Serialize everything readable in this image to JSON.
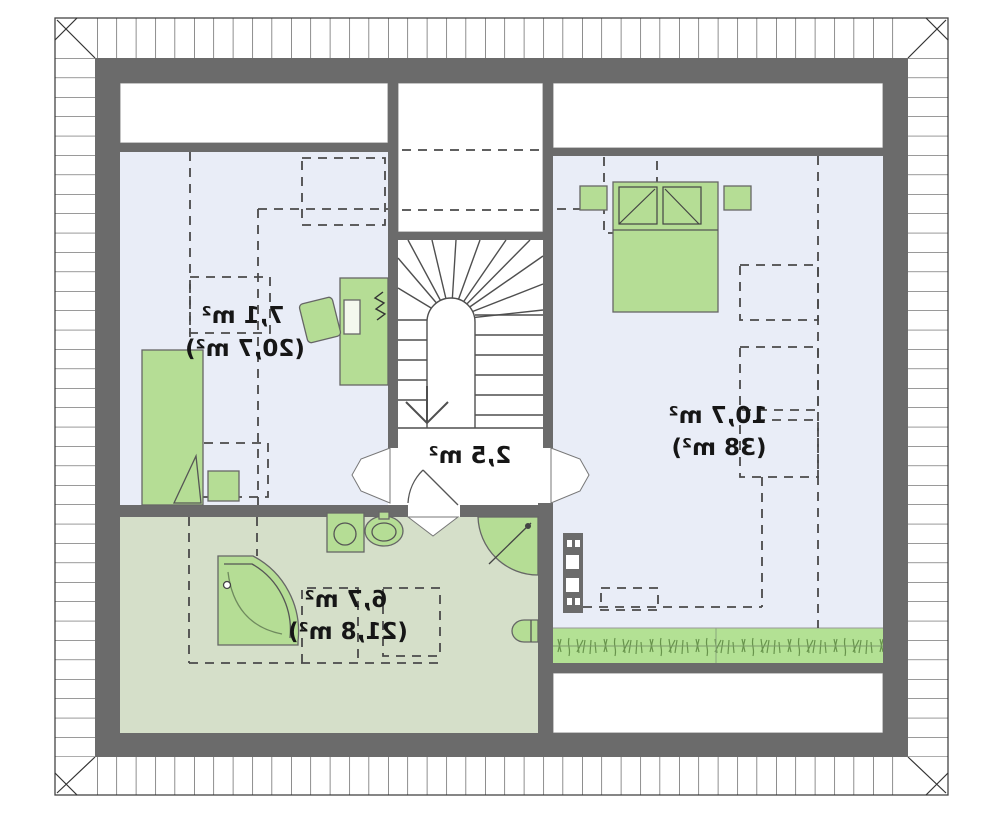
{
  "title": "Attic floor plan (mirrored)",
  "plan": {
    "room_left": {
      "name": "room-top-left",
      "area": "7,1 m²",
      "area_total": "(20,7 m²)"
    },
    "hall": {
      "name": "stair-hall",
      "area": "2,5 m²"
    },
    "bedroom": {
      "name": "bedroom-right",
      "area": "10,7 m²",
      "area_total": "(38 m²)"
    },
    "bathroom": {
      "name": "bathroom",
      "area": "6,7 m²",
      "area_total": "(21,8 m²)"
    },
    "colors": {
      "wall": "#6b6b6b",
      "room_floor": "#e9edf7",
      "bathroom_floor": "#d5dfc9",
      "furniture": "#b5dd95",
      "eaves_strip": "#b3e194"
    }
  }
}
